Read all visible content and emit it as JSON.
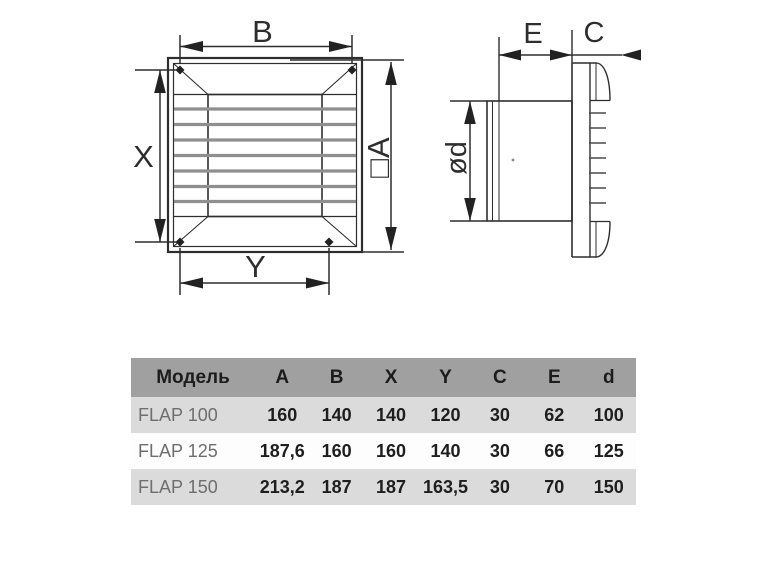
{
  "theme": {
    "page_bg": "#ffffff",
    "line_color": "#2e2e2e",
    "slat_color": "#8f8f8f",
    "hatch_color": "#4a4a4a",
    "table_header_bg": "#a0a0a0",
    "table_row_alt_bg": "#dbdbdb",
    "table_row_bg": "#fdfdfd",
    "table_header_text": "#1c1c1c",
    "table_model_text": "#6e6e6e",
    "table_value_text": "#1e1e1e"
  },
  "diagram": {
    "front_view": {
      "label_b": "B",
      "label_a": "□A",
      "label_x": "X",
      "label_y": "Y"
    },
    "side_view": {
      "label_e": "E",
      "label_c": "C",
      "label_d": "ød"
    }
  },
  "table": {
    "columns": [
      "Модель",
      "A",
      "B",
      "X",
      "Y",
      "C",
      "E",
      "d"
    ],
    "rows": [
      {
        "model": "FLAP 100",
        "values": [
          "160",
          "140",
          "140",
          "120",
          "30",
          "62",
          "100"
        ]
      },
      {
        "model": "FLAP 125",
        "values": [
          "187,6",
          "160",
          "160",
          "140",
          "30",
          "66",
          "125"
        ]
      },
      {
        "model": "FLAP 150",
        "values": [
          "213,2",
          "187",
          "187",
          "163,5",
          "30",
          "70",
          "150"
        ]
      }
    ]
  }
}
